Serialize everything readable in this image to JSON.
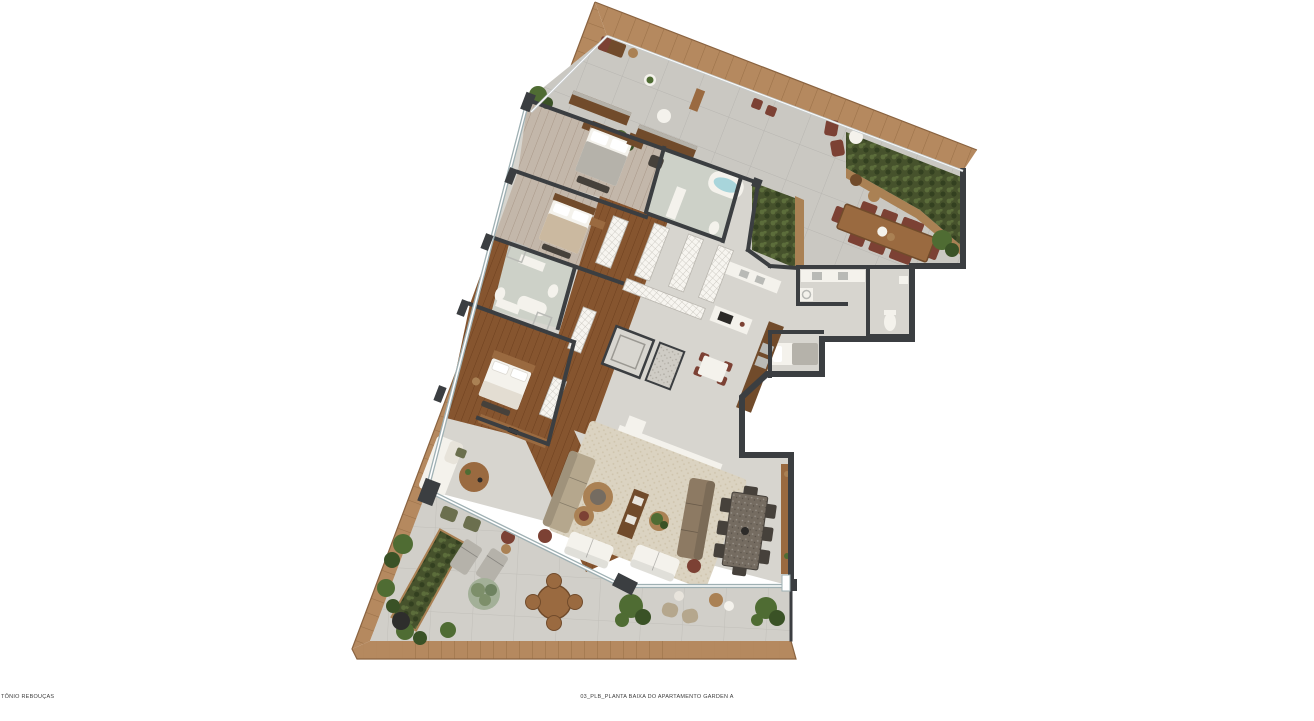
{
  "document": {
    "type": "architectural floor plan rendering",
    "captions": {
      "bottom_left": "TÔNIO REBOUÇAS",
      "bottom_center": "03_PLB_PLANTA BAIXA DO APARTAMENTO GARDEN A"
    }
  },
  "plan": {
    "unit_name": "Apartamento Garden A",
    "view": "planta baixa (top-down furnished plan)",
    "features": [
      "wood-deck-border",
      "upper-terrace",
      "vertical-garden-hedges",
      "outdoor-dining-table-10-seats",
      "terrace-lounge-benches",
      "suite-1-bedroom",
      "suite-1-bathroom-oval-tub",
      "suite-2-bedroom",
      "two-middle-bathrooms",
      "master-suite",
      "walk-in-closets",
      "elevator-core",
      "kitchen-island",
      "kitchen-bar-counter",
      "breakfast-table-4-seats",
      "laundry-room",
      "service-bathroom",
      "maid-room",
      "living-room-rug",
      "two-long-sofas",
      "two-white-loveseats",
      "indoor-dining-table-8-seats",
      "lower-terrace",
      "round-outdoor-table-4-seats",
      "sun-loungers",
      "planters-and-plants"
    ]
  },
  "palette": {
    "bg": "#ffffff",
    "deck": "#b5895f",
    "deckLine": "#9a7048",
    "deckEdge": "#8a6340",
    "tile": "#cac8c2",
    "tileLow": "#d1cfc9",
    "floor": "#d7d5cf",
    "bathFloor": "#cdd1c8",
    "woodFloor": "#86552f",
    "woodLine": "#6e401f",
    "suiteFloor": "#c3b7aa",
    "wall": "#3b3e41",
    "glass": "#9fb0b3",
    "white": "#f4f2ec",
    "hedge": "#46522c",
    "hedgeLeafA": "#5c6d3b",
    "hedgeLeafB": "#334020",
    "plant": "#4f6c33",
    "plantDark": "#3a5226",
    "planterWood": "#aa8154",
    "rug": "#dbd3c1",
    "rugDot": "#cec3ab",
    "sofaTan": "#b5a78d",
    "sofaBrown": "#8d7a63",
    "woodFurn": "#9a6a40",
    "woodFurnDark": "#714b2b",
    "tableDark": "#756c61",
    "chairDark": "#46413b",
    "maroon": "#7c4134",
    "water": "#a8d5db",
    "steel": "#b9bab6",
    "olive": "#6b6f4e",
    "grayItem": "#b5b2aa"
  }
}
